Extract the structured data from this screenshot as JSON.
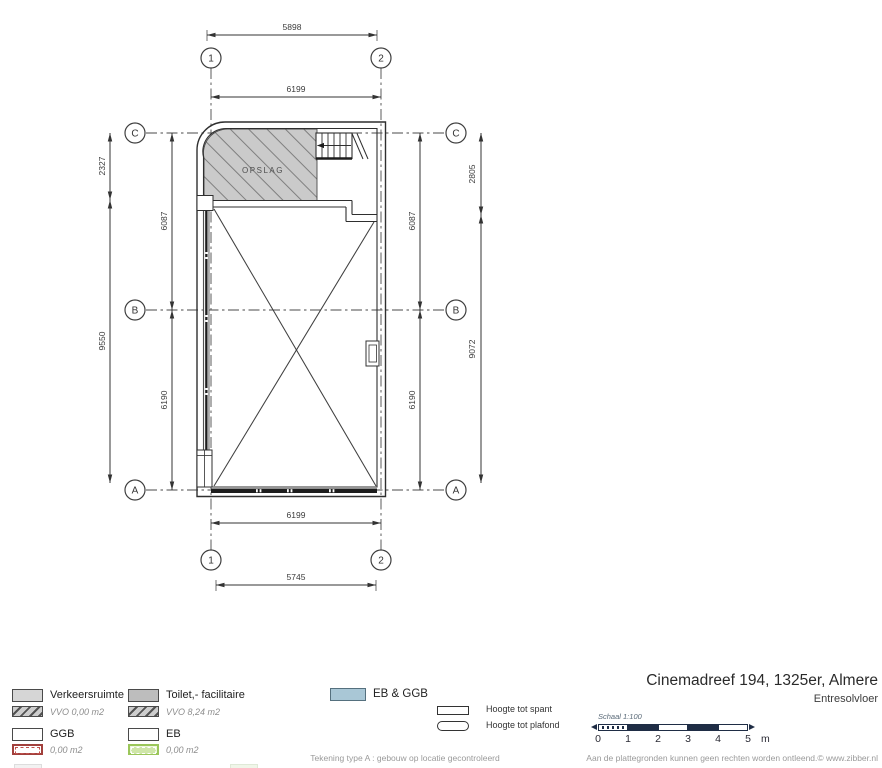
{
  "plan": {
    "room_label": "OPSLAG",
    "grid": {
      "col_1": "1",
      "col_2": "2",
      "row_a": "A",
      "row_b": "B",
      "row_c": "C"
    },
    "dimensions": {
      "top_outer": "5898",
      "top_inner": "6199",
      "bottom_inner": "6199",
      "bottom_outer": "5745",
      "left_outer_upper": "2327",
      "left_outer_lower": "9550",
      "left_inner_upper": "6087",
      "left_inner_lower": "6190",
      "right_inner_upper": "6087",
      "right_inner_lower": "6190",
      "right_outer_upper": "2805",
      "right_outer_lower": "9072"
    }
  },
  "legend": {
    "verkeersruimte": {
      "label": "Verkeersruimte",
      "sub": "VVO 0,00 m2"
    },
    "toilet": {
      "label": "Toilet,- facilitaire",
      "sub": "VVO 8,24 m2"
    },
    "ggb": {
      "label": "GGB",
      "sub": "0,00 m2"
    },
    "eb": {
      "label": "EB",
      "sub": "0,00 m2"
    },
    "eb_ggb": {
      "label": "EB & GGB"
    },
    "hoogte_spant": "Hoogte tot spant",
    "hoogte_plafond": "Hoogte tot plafond"
  },
  "title_block": {
    "title": "Cinemadreef 194, 1325er, Almere",
    "subtitle": "Entresolvloer"
  },
  "scale": {
    "label": "Schaal 1:100",
    "ticks": [
      "0",
      "1",
      "2",
      "3",
      "4",
      "5"
    ],
    "unit": "m"
  },
  "footer": {
    "center": "Tekening type A : gebouw op locatie gecontroleerd",
    "right": "Aan de plattegronden kunnen geen rechten worden ontleend.© www.zibber.nl"
  },
  "colors": {
    "line": "#3c3c3c",
    "hatch_fill": "#cacaca",
    "eb_ggb_fill": "#a9c7d6",
    "ggb_red": "#a2403c",
    "eb_green": "#9bc65a",
    "scalebar": "#1f2d45"
  }
}
